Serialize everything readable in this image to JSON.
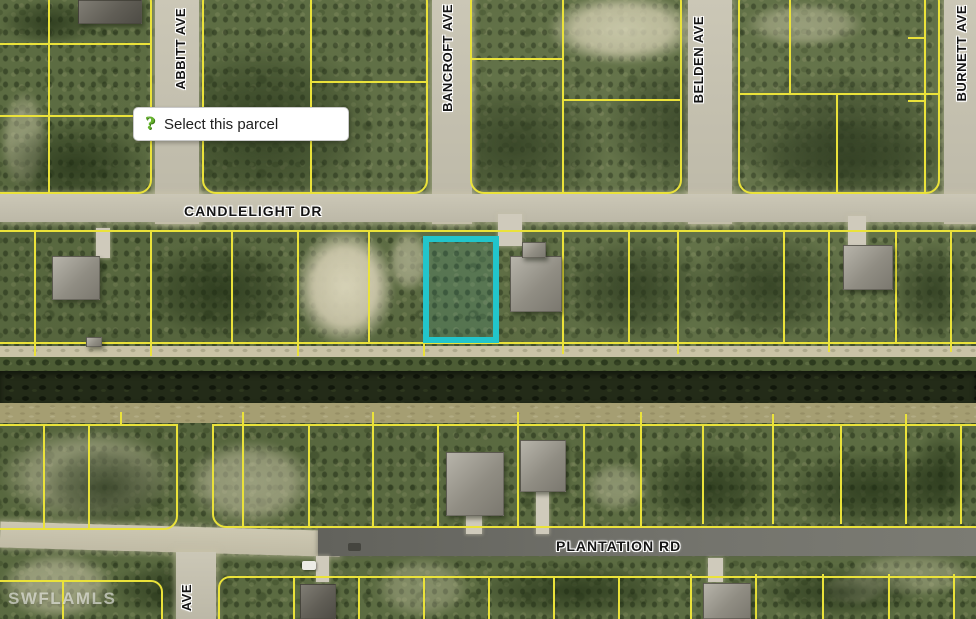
{
  "watermark": {
    "text": "SWFLAMLS"
  },
  "tooltip": {
    "icon": "help-question-icon",
    "icon_glyph": "?",
    "text": "Select this parcel"
  },
  "streets": {
    "abbitt": "ABBITT AVE",
    "bancroft": "BANCROFT AVE",
    "belden": "BELDEN AVE",
    "burnett": "BURNETT AVE",
    "candlelight": "CANDLELIGHT DR",
    "plantation": "PLANTATION RD",
    "abbitt_south": "AVE"
  },
  "colors": {
    "parcel_line": "#eae23a",
    "selected_parcel": "#22c5cb",
    "road_light": "#c6c2b0",
    "road_asphalt": "#6b6b66",
    "tooltip_icon_green": "#66b32e"
  },
  "selected_parcel": {
    "x": 423,
    "y": 236,
    "width": 76,
    "height": 107
  },
  "features": {
    "roads": [
      [
        155,
        0,
        44,
        224,
        "light"
      ],
      [
        432,
        0,
        40,
        224,
        "light"
      ],
      [
        688,
        0,
        44,
        224,
        "light"
      ],
      [
        944,
        0,
        32,
        224,
        "light"
      ],
      [
        0,
        194,
        976,
        28,
        "light"
      ],
      [
        0,
        531,
        340,
        26,
        "dirt"
      ],
      [
        318,
        528,
        658,
        28,
        "dark"
      ],
      [
        176,
        552,
        40,
        67,
        "light"
      ]
    ],
    "blocks": [
      [
        -12,
        -12,
        164,
        206,
        "all"
      ],
      [
        202,
        -12,
        226,
        206,
        "all"
      ],
      [
        470,
        -12,
        212,
        206,
        "all"
      ],
      [
        738,
        -12,
        202,
        206,
        "all"
      ],
      [
        -12,
        230,
        1000,
        114,
        ""
      ],
      [
        -12,
        424,
        190,
        106,
        "br"
      ],
      [
        212,
        424,
        788,
        104,
        "bl"
      ],
      [
        -12,
        580,
        175,
        60,
        "tr"
      ],
      [
        218,
        576,
        782,
        60,
        "tl"
      ]
    ],
    "lines": [
      [
        48,
        0,
        2,
        192
      ],
      [
        0,
        43,
        150,
        2
      ],
      [
        0,
        115,
        150,
        2
      ],
      [
        310,
        0,
        2,
        192
      ],
      [
        310,
        81,
        118,
        2
      ],
      [
        562,
        0,
        2,
        192
      ],
      [
        470,
        58,
        94,
        2
      ],
      [
        562,
        99,
        120,
        2
      ],
      [
        738,
        93,
        200,
        2
      ],
      [
        789,
        0,
        2,
        93
      ],
      [
        836,
        95,
        2,
        97
      ],
      [
        924,
        0,
        2,
        192
      ],
      [
        908,
        37,
        16,
        2
      ],
      [
        908,
        100,
        16,
        2
      ],
      [
        34,
        230,
        2,
        114
      ],
      [
        150,
        230,
        2,
        114
      ],
      [
        231,
        230,
        2,
        114
      ],
      [
        297,
        230,
        2,
        114
      ],
      [
        368,
        230,
        2,
        114
      ],
      [
        562,
        232,
        2,
        112
      ],
      [
        628,
        232,
        2,
        112
      ],
      [
        677,
        232,
        2,
        112
      ],
      [
        783,
        232,
        2,
        110
      ],
      [
        828,
        232,
        2,
        110
      ],
      [
        895,
        232,
        2,
        110
      ],
      [
        950,
        232,
        2,
        110
      ],
      [
        34,
        344,
        2,
        12
      ],
      [
        150,
        344,
        2,
        12
      ],
      [
        297,
        344,
        2,
        12
      ],
      [
        423,
        344,
        2,
        12
      ],
      [
        562,
        342,
        2,
        12
      ],
      [
        677,
        342,
        2,
        12
      ],
      [
        828,
        340,
        2,
        12
      ],
      [
        950,
        340,
        2,
        12
      ],
      [
        43,
        424,
        2,
        104
      ],
      [
        88,
        424,
        2,
        104
      ],
      [
        242,
        424,
        2,
        102
      ],
      [
        308,
        424,
        2,
        102
      ],
      [
        372,
        424,
        2,
        102
      ],
      [
        437,
        424,
        2,
        102
      ],
      [
        517,
        424,
        2,
        102
      ],
      [
        583,
        424,
        2,
        102
      ],
      [
        640,
        424,
        2,
        102
      ],
      [
        702,
        424,
        2,
        100
      ],
      [
        772,
        424,
        2,
        100
      ],
      [
        840,
        424,
        2,
        100
      ],
      [
        905,
        424,
        2,
        100
      ],
      [
        960,
        424,
        2,
        100
      ],
      [
        120,
        412,
        2,
        14
      ],
      [
        242,
        412,
        2,
        14
      ],
      [
        372,
        412,
        2,
        14
      ],
      [
        517,
        412,
        2,
        14
      ],
      [
        640,
        412,
        2,
        14
      ],
      [
        772,
        414,
        2,
        12
      ],
      [
        905,
        414,
        2,
        12
      ],
      [
        62,
        580,
        2,
        39
      ],
      [
        293,
        576,
        2,
        43
      ],
      [
        358,
        576,
        2,
        43
      ],
      [
        423,
        576,
        2,
        43
      ],
      [
        488,
        576,
        2,
        43
      ],
      [
        553,
        576,
        2,
        43
      ],
      [
        618,
        576,
        2,
        43
      ],
      [
        690,
        574,
        2,
        45
      ],
      [
        755,
        574,
        2,
        45
      ],
      [
        822,
        574,
        2,
        45
      ],
      [
        888,
        574,
        2,
        45
      ],
      [
        953,
        574,
        2,
        45
      ]
    ],
    "sand": [
      [
        548,
        -6,
        150,
        70,
        0.75
      ],
      [
        745,
        2,
        120,
        45,
        0.4
      ],
      [
        295,
        228,
        100,
        118,
        0.95
      ],
      [
        388,
        230,
        42,
        62,
        0.5
      ],
      [
        0,
        428,
        175,
        95,
        0.45
      ],
      [
        185,
        440,
        130,
        85,
        0.5
      ],
      [
        585,
        462,
        65,
        50,
        0.35
      ],
      [
        0,
        552,
        115,
        67,
        0.5
      ],
      [
        845,
        552,
        131,
        45,
        0.3
      ],
      [
        0,
        90,
        48,
        100,
        0.4
      ],
      [
        822,
        573,
        64,
        32,
        0.45
      ],
      [
        375,
        556,
        95,
        63,
        0.3
      ],
      [
        140,
        178,
        80,
        50,
        0.3
      ]
    ],
    "trees": [
      [
        150,
        40,
        230,
        170
      ],
      [
        420,
        80,
        190,
        130
      ],
      [
        0,
        120,
        150,
        90
      ],
      [
        600,
        55,
        170,
        140
      ],
      [
        730,
        70,
        230,
        130
      ],
      [
        740,
        120,
        220,
        80
      ],
      [
        140,
        240,
        160,
        100
      ],
      [
        560,
        235,
        150,
        105
      ],
      [
        690,
        232,
        160,
        108
      ],
      [
        890,
        240,
        86,
        100
      ],
      [
        40,
        445,
        130,
        85
      ],
      [
        640,
        445,
        140,
        85
      ],
      [
        780,
        450,
        186,
        80
      ],
      [
        910,
        430,
        66,
        90
      ],
      [
        110,
        560,
        130,
        60
      ],
      [
        470,
        562,
        210,
        57
      ],
      [
        755,
        565,
        170,
        54
      ],
      [
        0,
        0,
        100,
        45
      ]
    ],
    "houses": [
      [
        78,
        0,
        64,
        24,
        "dark"
      ],
      [
        52,
        256,
        48,
        44,
        "light"
      ],
      [
        510,
        256,
        52,
        56,
        "light"
      ],
      [
        522,
        242,
        24,
        16,
        "light"
      ],
      [
        843,
        245,
        50,
        45,
        "light"
      ],
      [
        446,
        452,
        58,
        64,
        "light"
      ],
      [
        520,
        440,
        46,
        52,
        "light"
      ],
      [
        300,
        584,
        36,
        35,
        "dark"
      ],
      [
        703,
        583,
        48,
        36,
        "light"
      ],
      [
        86,
        337,
        16,
        10,
        "light"
      ]
    ],
    "driveways": [
      [
        96,
        228,
        14,
        30
      ],
      [
        498,
        214,
        24,
        32
      ],
      [
        848,
        216,
        18,
        31
      ],
      [
        466,
        514,
        16,
        20
      ],
      [
        536,
        490,
        13,
        44
      ],
      [
        316,
        556,
        13,
        26
      ],
      [
        708,
        558,
        15,
        24
      ]
    ],
    "vehicles": [
      [
        302,
        561,
        14,
        9,
        "white"
      ],
      [
        348,
        543,
        13,
        8,
        "dark"
      ]
    ]
  }
}
